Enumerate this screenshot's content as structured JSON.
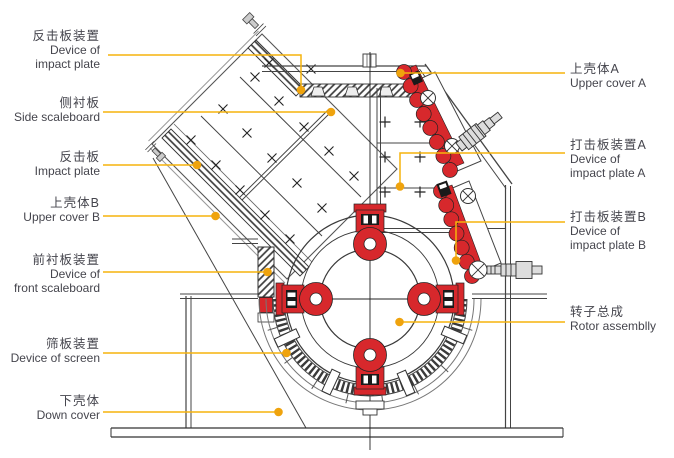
{
  "diagram": {
    "type": "impact-crusher cross-section engineering drawing",
    "labels_left": [
      {
        "cn": "反击板装置",
        "en": "Device of\nimpact plate"
      },
      {
        "cn": "侧衬板",
        "en": "Side scaleboard"
      },
      {
        "cn": "反击板",
        "en": "Impact plate"
      },
      {
        "cn": "上壳体B",
        "en": "Upper cover B"
      },
      {
        "cn": "前衬板装置",
        "en": "Device of\nfront scaleboard"
      },
      {
        "cn": "筛板装置",
        "en": "Device of screen"
      },
      {
        "cn": "下壳体",
        "en": "Down cover"
      }
    ],
    "labels_right": [
      {
        "cn": "上壳体A",
        "en": "Upper cover A"
      },
      {
        "cn": "打击板装置A",
        "en": "Device of\nimpact plate A"
      },
      {
        "cn": "打击板装置B",
        "en": "Device of\nimpact plate B"
      },
      {
        "cn": "转子总成",
        "en": "Rotor assemblly"
      }
    ],
    "colors": {
      "highlight_red": "#d7282c",
      "callout_yellow": "#f6b40d",
      "callout_dot": "#efa30d",
      "line_dark": "#45454d"
    }
  }
}
